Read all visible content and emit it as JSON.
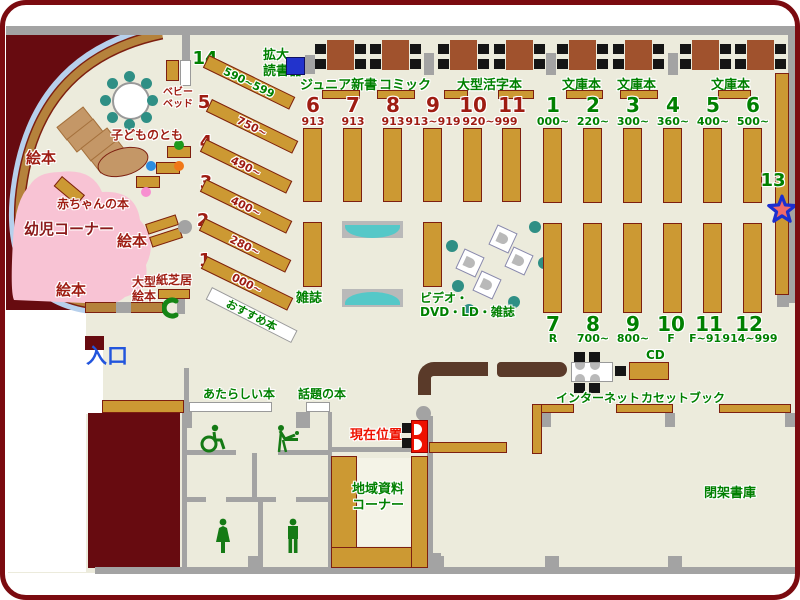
{
  "title": "library-floor-map",
  "colors": {
    "floor": "#ecebdc",
    "wall": "#a3a3a3",
    "shelf": "#cc9933",
    "shelf_border": "#7d1f10",
    "maroon": "#670b10",
    "frame": "#7b0b10",
    "pink_area": "#f8c3d4",
    "table": "#a0522d",
    "counter": "#5a3a29",
    "teal_seat": "#2f8f85",
    "teal_bench": "#55c8c8",
    "green_text": "#008000",
    "darkred_text": "#9e1c12",
    "red_text": "#ee1100",
    "blue_text": "#2255dd",
    "device_blue": "#2233cc",
    "arc_blue": "#b7d0ec",
    "arc_brown": "#b5823c"
  },
  "children_area": {
    "corner_label": "幼児コーナー",
    "ehon_left": "絵本",
    "ehon_mid": "絵本",
    "ehon_bottom": "絵本",
    "baby_books": "赤ちゃんの本",
    "kodomo_no_tomo": "子どものとも",
    "baby_bed": "ベビー\nベッド",
    "ogata_ehon": "大型\n絵本",
    "kamishibai": "紙芝居"
  },
  "entrance_label": "入口",
  "device": {
    "label": "拡大\n読書器"
  },
  "top_labels": {
    "junior": "ジュニア新書",
    "comic": "コミック",
    "large_print": "大型活字本",
    "bunko": "文庫本"
  },
  "left_stacks": {
    "recommended": "おすすめ本",
    "items": [
      {
        "no": "14",
        "range": "590~599"
      },
      {
        "no": "5",
        "range": "750~"
      },
      {
        "no": "4",
        "range": "490~"
      },
      {
        "no": "3",
        "range": "400~"
      },
      {
        "no": "2",
        "range": "280~"
      },
      {
        "no": "1",
        "range": "000~"
      }
    ]
  },
  "mid_stacks": {
    "items": [
      {
        "no": "6",
        "range": "913"
      },
      {
        "no": "7",
        "range": "913"
      },
      {
        "no": "8",
        "range": "913"
      },
      {
        "no": "9",
        "range": "913~919"
      },
      {
        "no": "10",
        "range": "920~999"
      },
      {
        "no": "11",
        "range": ""
      }
    ]
  },
  "right_stacks_top": [
    {
      "no": "1",
      "range": "000~"
    },
    {
      "no": "2",
      "range": "220~"
    },
    {
      "no": "3",
      "range": "300~"
    },
    {
      "no": "4",
      "range": "360~"
    },
    {
      "no": "5",
      "range": "400~"
    },
    {
      "no": "6",
      "range": "500~"
    }
  ],
  "right_stacks_bottom": [
    {
      "no": "7",
      "range": "R"
    },
    {
      "no": "8",
      "range": "700~"
    },
    {
      "no": "9",
      "range": "800~"
    },
    {
      "no": "10",
      "range": "F"
    },
    {
      "no": "11",
      "range": "F~914"
    },
    {
      "no": "12",
      "range": "914~999"
    }
  ],
  "stack13": {
    "no": "13"
  },
  "center_labels": {
    "magazines": "雑誌",
    "video": "ビデオ・\nDVD・LD・雑誌"
  },
  "services": {
    "internet": "インターネット",
    "cd": "CD",
    "cassette": "カセットブック",
    "closed_stacks": "閉架書庫",
    "local_materials": "地域資料\nコーナー",
    "current_location": "現在位置",
    "new_books": "あたらしい本",
    "topical_books": "話題の本"
  }
}
